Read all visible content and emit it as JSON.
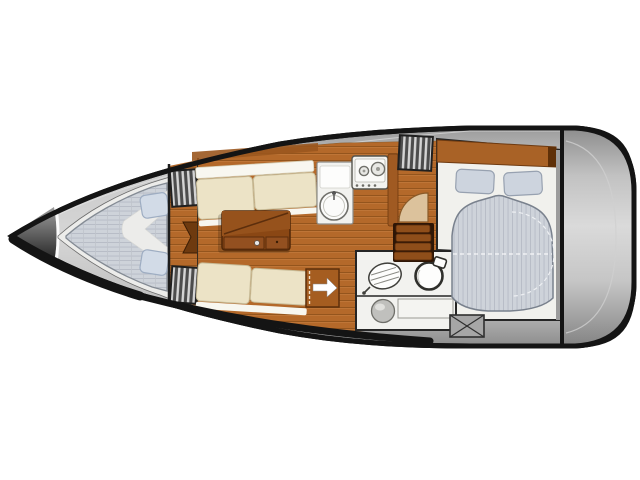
{
  "meta": {
    "width": 640,
    "height": 480,
    "background": "#ffffff",
    "type": "sailboat-interior-floor-plan",
    "view": "top-down",
    "orientation": "bow-left-stern-right"
  },
  "colors": {
    "hull_outline": "#141414",
    "deck_light": "#d6d6d6",
    "deck_dark": "#8d8d8d",
    "wood_base": "#b4692a",
    "wood_plank_line": "#94551d",
    "wood_highlight": "#c1783a",
    "wood_trim": "#a05a22",
    "wood_dark": "#6e3a0f",
    "table_top": "#8a4714",
    "table_edge": "#4f2708",
    "settee_cushion": "#ece3c6",
    "settee_trim": "#f8f7f0",
    "mattress_base": "#ced3da",
    "mattress_stripe": "#b5bbc5",
    "pillow_fill": "#d2dbe7",
    "aft_pillow_fill": "#cdd4de",
    "fixture_white": "#f2f2ef",
    "steps_wood": "#8f4e1a",
    "hatch_dark": "#4c4c4c",
    "hatch_slat": "#d4d4d4",
    "door_wood": "#a55d20",
    "arrow_white": "#ffffff",
    "box_gray": "#a6a6a6",
    "door_arc_tan": "#dcc29c"
  },
  "areas": {
    "anchor_locker": {
      "name": "anchor-locker"
    },
    "v_berth": {
      "name": "v-berth-cabin",
      "pillow_count": 2,
      "berth_type": "double-v"
    },
    "saloon": {
      "name": "saloon",
      "settee_count": 2,
      "table_count": 1
    },
    "galley": {
      "name": "galley",
      "stove_burners": 2,
      "sink_count": 1
    },
    "companionway": {
      "name": "companionway",
      "step_count": 4,
      "entry_arrow_direction": "right"
    },
    "head": {
      "name": "head-compartment",
      "fixtures": [
        "toilet",
        "washbasin",
        "shower-seat"
      ]
    },
    "aft_cabin": {
      "name": "aft-cabin",
      "pillow_count": 2,
      "berth_type": "double"
    },
    "transom": {
      "name": "stern-transom"
    }
  }
}
